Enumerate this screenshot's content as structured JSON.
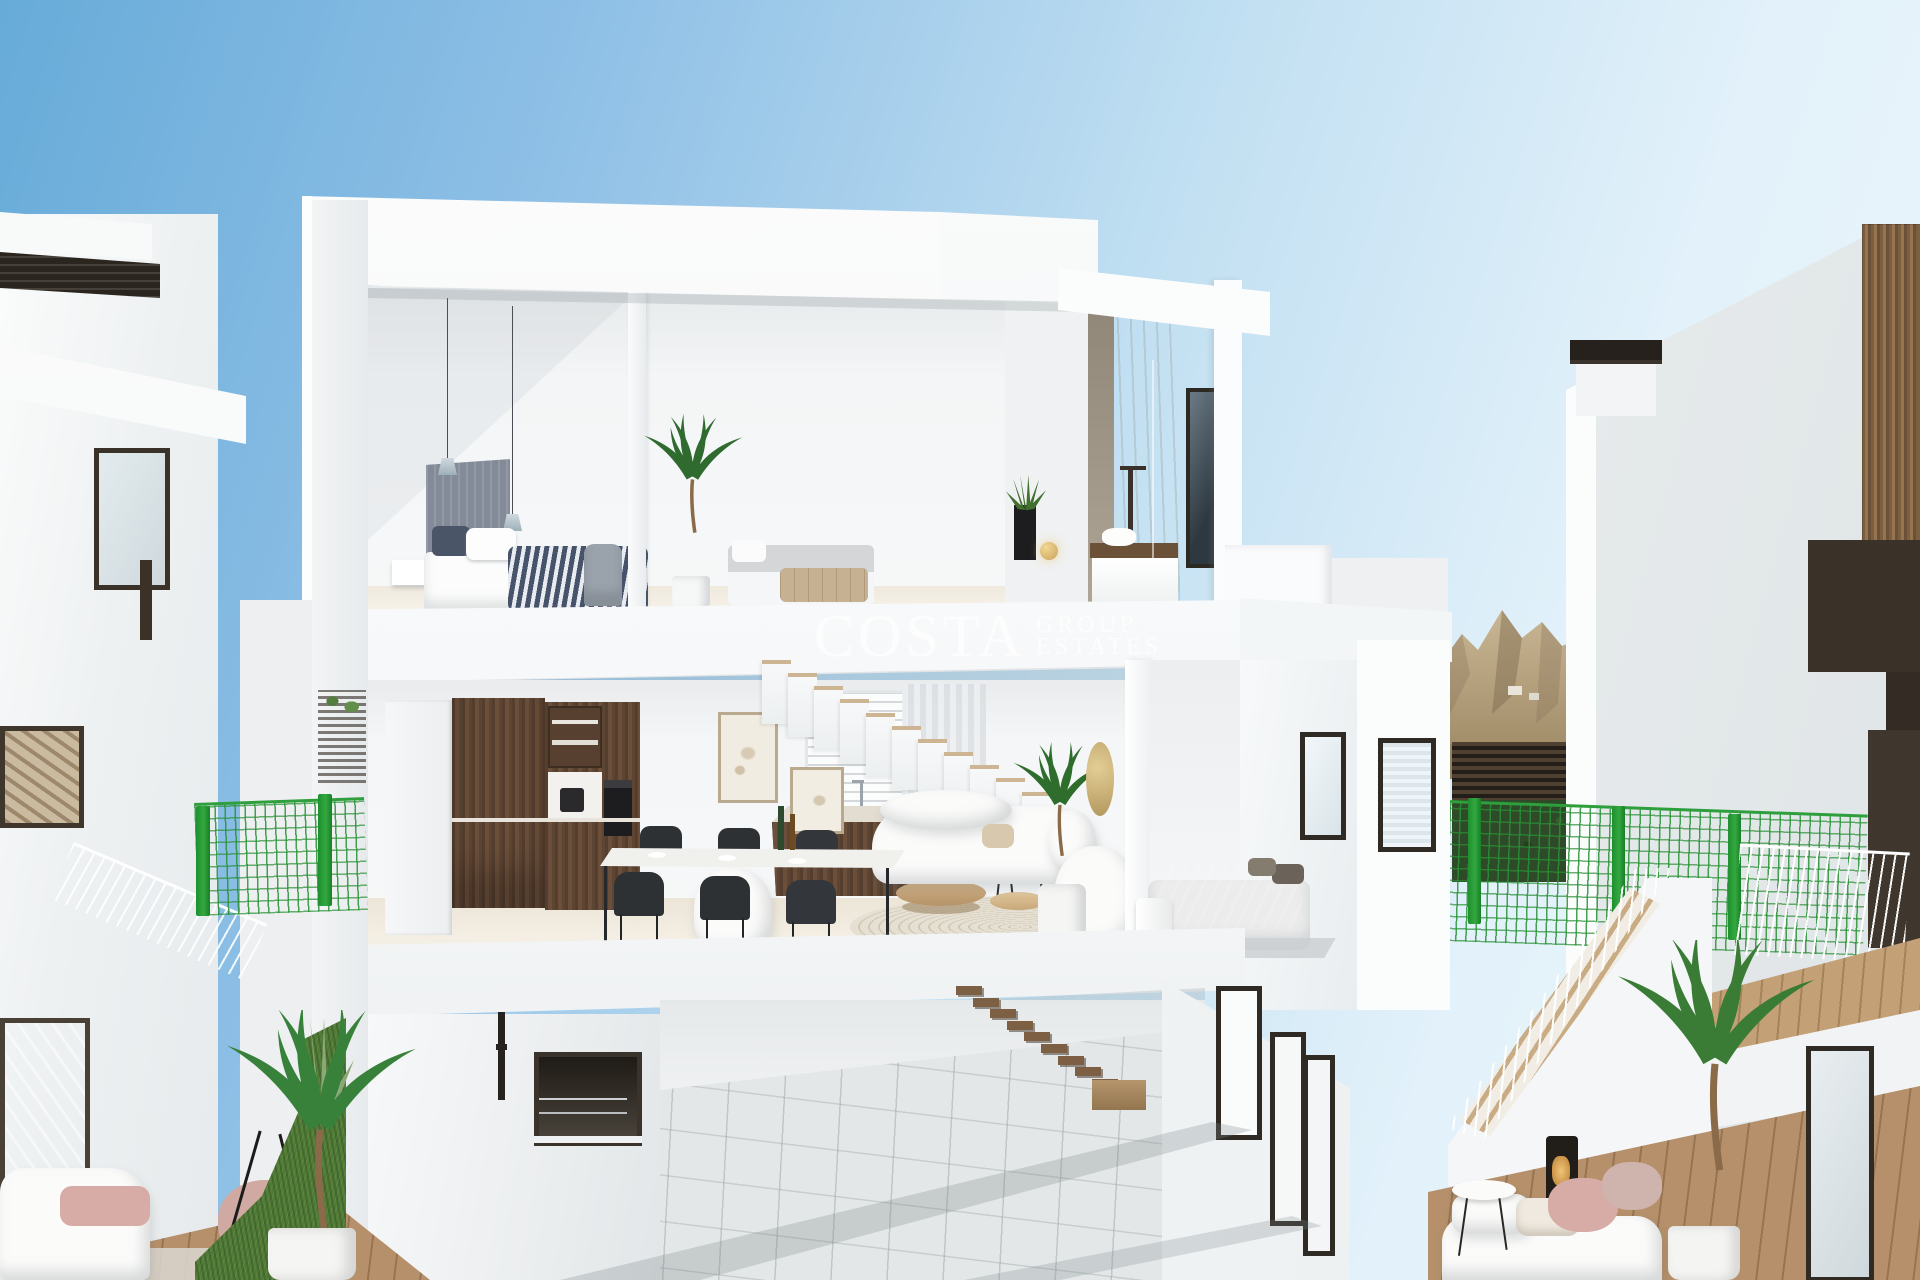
{
  "watermark": {
    "brand": "COSTA",
    "word1": "GROUP",
    "word2": "ESTATES",
    "color": "#ffffff"
  },
  "palette": {
    "sky_top": "#67abd9",
    "sky_pale": "#eef7fc",
    "fence_green": "#2f9e3c",
    "grass_green": "#507c35",
    "palm_green": "#3a7c35",
    "wood_dark": "#5d4533",
    "wood_light": "#cdb493",
    "mountain_tan": "#b3a083",
    "pergola_brown": "#44372a",
    "frame_dark": "#2f2a24",
    "headboard_gray": "#848b98",
    "bedding_navy": "#47536b",
    "cushion_pink": "#d8aca6",
    "gold_accent": "#c9a35a",
    "concrete_beige": "#c5baa9",
    "watermark": "#ffffff"
  }
}
